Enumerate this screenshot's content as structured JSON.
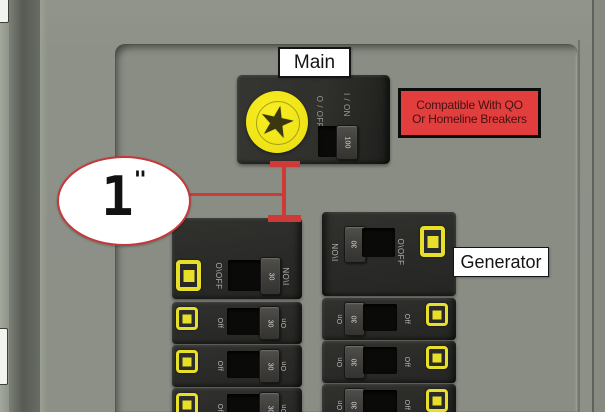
{
  "callouts": {
    "main_label": "Main",
    "generator_label": "Generator",
    "compat_line1": "Compatible With QO",
    "compat_line2": "Or Homeline Breakers",
    "gap_value": "1",
    "gap_unit": "\""
  },
  "main_breaker": {
    "off_label": "O / OFF",
    "on_label": "I / ON",
    "handle_rating": "100"
  },
  "interlock_left": {
    "off_label": "O\\OFF",
    "on_label": "I\\ON",
    "handle_rating": "30"
  },
  "interlock_right": {
    "off_label": "O\\OFF",
    "on_label": "I\\ON",
    "handle_rating": "30"
  },
  "branch": {
    "off_label": "Off",
    "on_label": "On",
    "handle_rating": "30"
  },
  "icons": {
    "star": "★"
  },
  "colors": {
    "panel_gray": "#8a8e85",
    "breaker_black": "#2c2c2a",
    "accent_yellow": "#e8df2a",
    "callout_red": "#cf3a36",
    "compat_label_bg": "#e23e3e"
  }
}
